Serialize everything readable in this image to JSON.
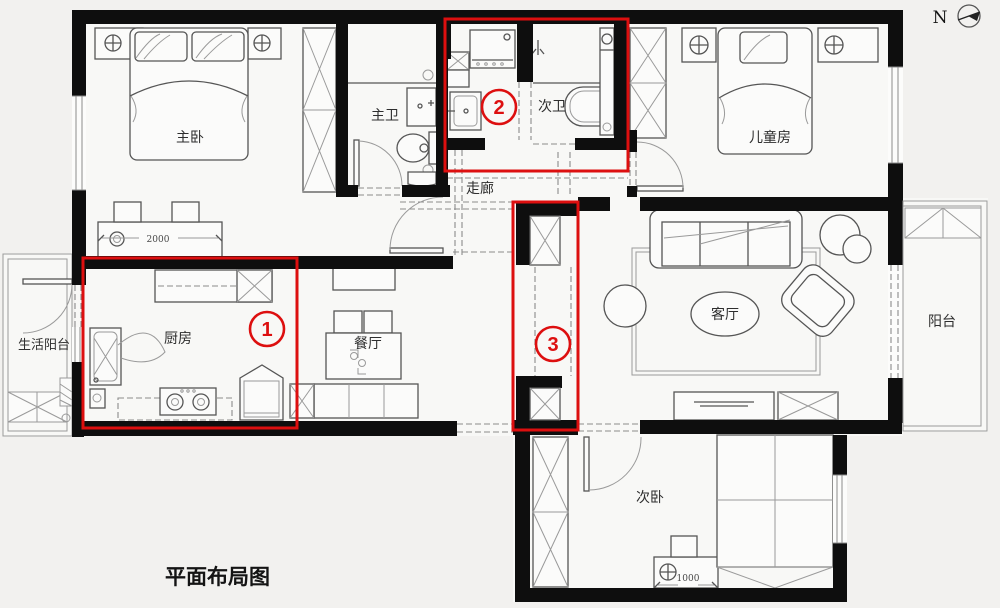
{
  "title": "平面布局图",
  "compass": {
    "label": "N"
  },
  "rooms": {
    "master_bedroom": {
      "label": "主卧"
    },
    "master_bath": {
      "label": "主卫"
    },
    "second_bath": {
      "label": "次卫"
    },
    "kids_room": {
      "label": "儿童房"
    },
    "corridor": {
      "label": "走廊"
    },
    "kitchen": {
      "label": "厨房"
    },
    "dining": {
      "label": "餐厅"
    },
    "living": {
      "label": "客厅"
    },
    "balcony": {
      "label": "阳台"
    },
    "service_balcony": {
      "label": "生活阳台"
    },
    "second_bedroom": {
      "label": "次卧"
    }
  },
  "annotations": {
    "markers": [
      {
        "number": "1"
      },
      {
        "number": "2"
      },
      {
        "number": "3"
      }
    ],
    "highlight_color": "#dd0f0f"
  },
  "dimensions": [
    {
      "value": "2000"
    },
    {
      "value": "1000"
    }
  ],
  "colors": {
    "background": "#f2f1ef",
    "wall": "#0e0e0e",
    "furniture_line": "#555555",
    "red": "#dd0f0f"
  }
}
